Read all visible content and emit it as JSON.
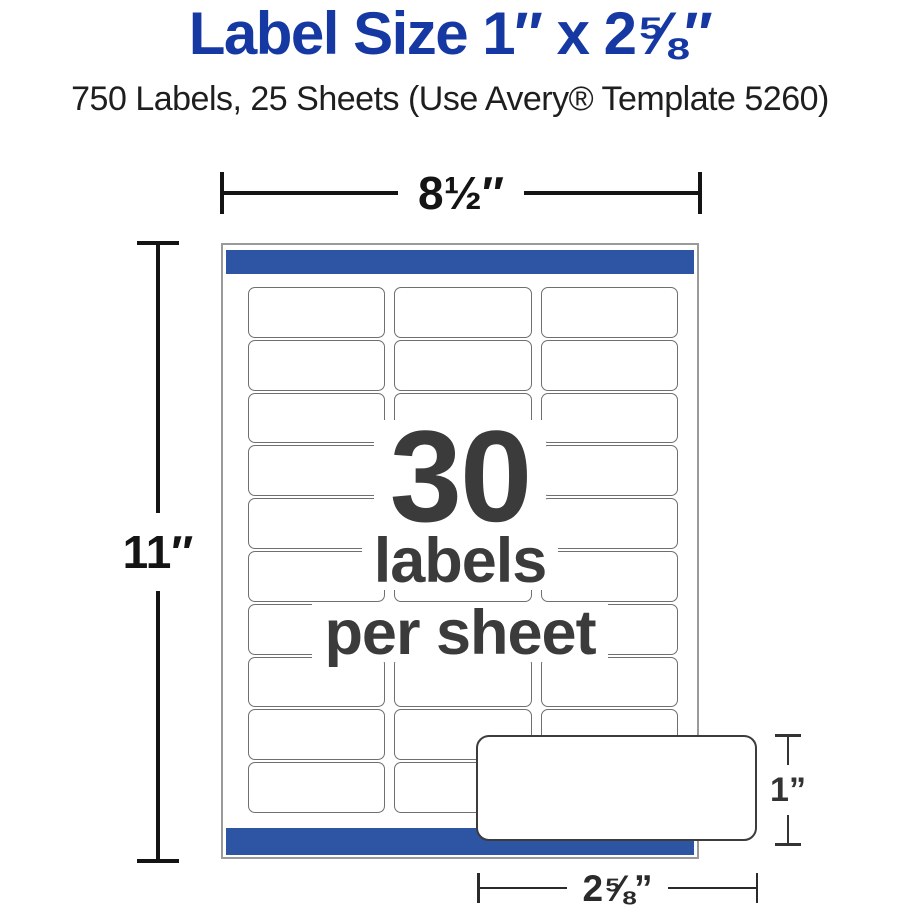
{
  "header": {
    "title": "Label Size 1″ x 2⅝″",
    "subtitle": "750 Labels, 25 Sheets (Use Avery® Template 5260)"
  },
  "diagram": {
    "sheet_width_value": "8½″",
    "sheet_height_value": "11″",
    "overlay": {
      "count": "30",
      "caption_line1": "labels",
      "caption_line2": "per sheet"
    },
    "grid": {
      "columns": 3,
      "rows": 10
    },
    "enlarged_label": {
      "height_value": "1”",
      "width_value": "2⅝”"
    }
  },
  "colors": {
    "title_blue": "#1638a3",
    "bar_blue": "#2e55a4",
    "overlay_text": "#3b3b3b",
    "dimension": "#141414",
    "label_border": "#6f6f6f",
    "sheet_border": "#9a9a9a"
  }
}
